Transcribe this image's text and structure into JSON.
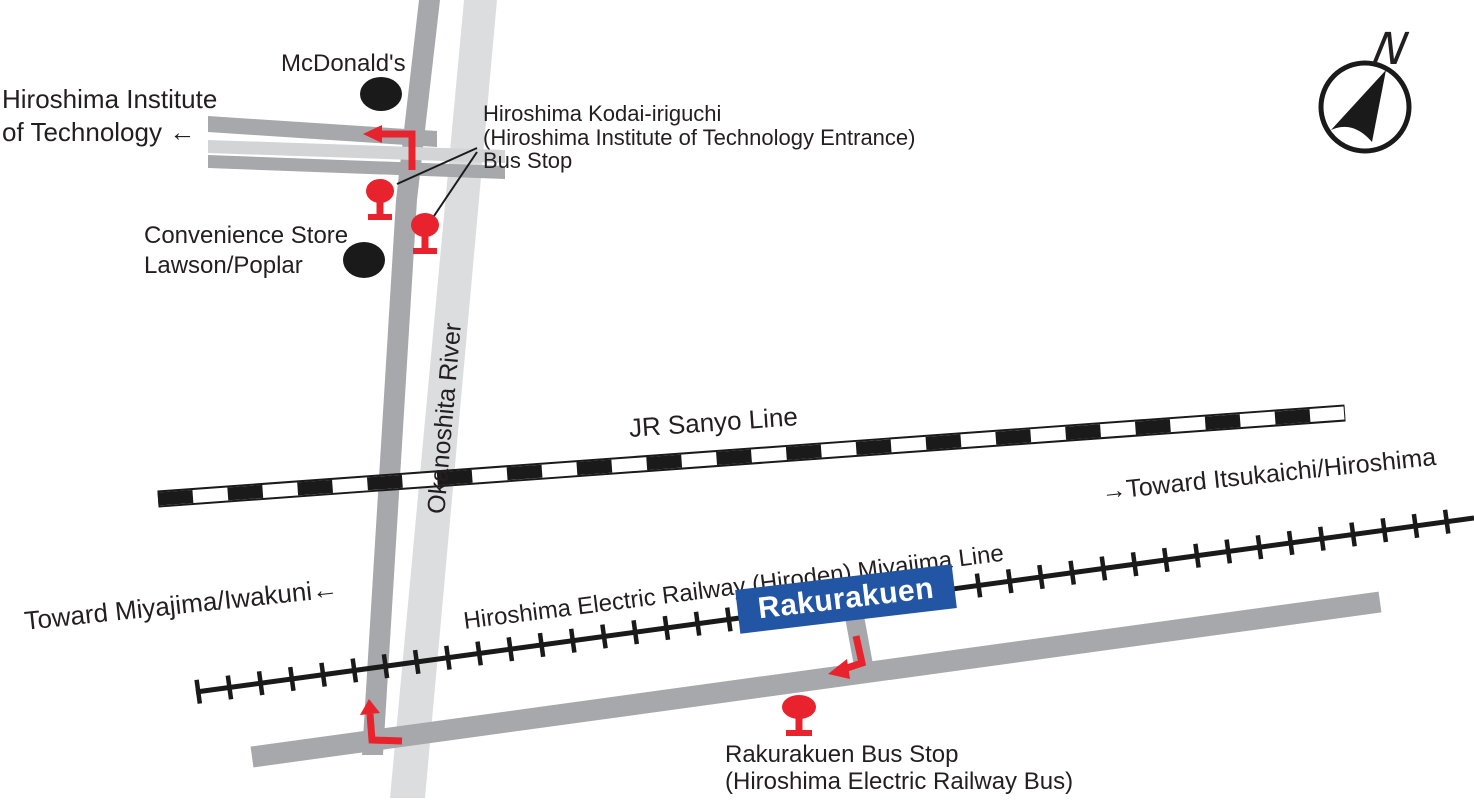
{
  "colors": {
    "road": "#a6a8ab",
    "band": "#d2d4d6",
    "river": "#dcddde",
    "rail": "#1a1a1a",
    "red": "#e8232d",
    "blue": "#2255a4",
    "text": "#231f20"
  },
  "compass": {
    "label": "N"
  },
  "destinations": {
    "hit_line1": "Hiroshima Institute",
    "hit_line2": "of Technology ←",
    "toward_itsukaichi": "→Toward Itsukaichi/Hiroshima",
    "toward_miyajima": "Toward Miyajima/Iwakuni←"
  },
  "pois": {
    "mcdonalds": "McDonald's",
    "convenience_line1": "Convenience Store",
    "convenience_line2": "Lawson/Poplar"
  },
  "river": {
    "name": "Okanoshita River"
  },
  "railways": {
    "jr": "JR Sanyo Line",
    "hiroden": "Hiroshima Electric Railway (Hiroden) Miyajima Line",
    "station": "Rakurakuen"
  },
  "bus_stops": {
    "kodai_line1": "Hiroshima Kodai-iriguchi",
    "kodai_line2": "(Hiroshima Institute of Technology Entrance)",
    "kodai_line3": "Bus Stop",
    "rakurakuen_line1": "Rakurakuen Bus Stop",
    "rakurakuen_line2": "(Hiroshima Electric Railway Bus)"
  }
}
